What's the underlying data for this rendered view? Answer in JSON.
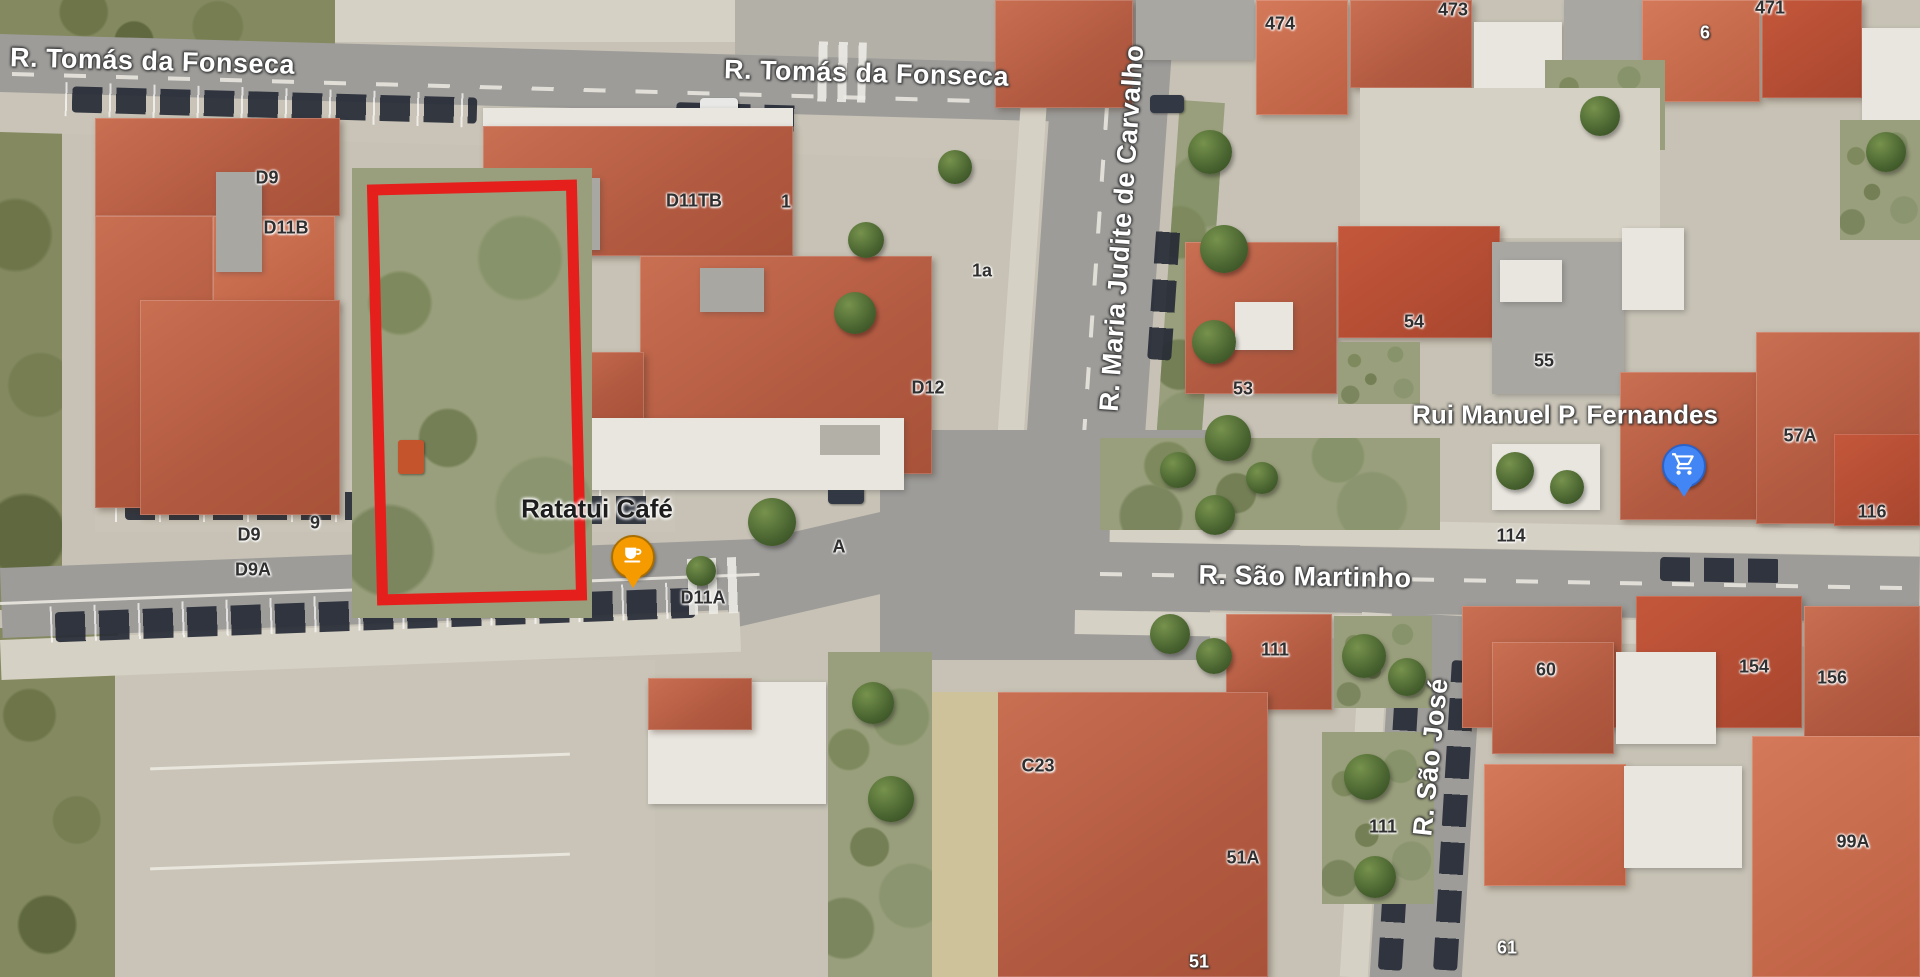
{
  "map_type": "satellite",
  "street_labels": [
    {
      "id": "r-tomas-da-fonseca-west",
      "text": "R. Tomás da Fonseca",
      "x": 10,
      "y": 46,
      "rotate": 1.5,
      "size": 27,
      "anchor": "topleft"
    },
    {
      "id": "r-tomas-da-fonseca-center",
      "text": "R. Tomás da Fonseca",
      "x": 724,
      "y": 58,
      "rotate": 1.5,
      "size": 27,
      "anchor": "topleft"
    },
    {
      "id": "r-maria-judite-de-carvalho",
      "text": "R. Maria Judite de Carvalho",
      "x": 1122,
      "y": 228,
      "rotate": -86,
      "size": 27,
      "anchor": "center"
    },
    {
      "id": "r-sao-martinho",
      "text": "R. São Martinho",
      "x": 1305,
      "y": 577,
      "rotate": 1,
      "size": 27,
      "anchor": "center"
    },
    {
      "id": "r-sao-jose",
      "text": "R. São José",
      "x": 1431,
      "y": 757,
      "rotate": -84,
      "size": 27,
      "anchor": "center"
    }
  ],
  "building_labels": [
    {
      "text": "D9",
      "x": 267,
      "y": 178
    },
    {
      "text": "D11B",
      "x": 286,
      "y": 228
    },
    {
      "text": "D11TB",
      "x": 694,
      "y": 201
    },
    {
      "text": "1",
      "x": 786,
      "y": 202
    },
    {
      "text": "1a",
      "x": 982,
      "y": 271
    },
    {
      "text": "D12",
      "x": 928,
      "y": 388
    },
    {
      "text": "9",
      "x": 315,
      "y": 523
    },
    {
      "text": "D9",
      "x": 249,
      "y": 535
    },
    {
      "text": "D9A",
      "x": 253,
      "y": 570
    },
    {
      "text": "A",
      "x": 839,
      "y": 547
    },
    {
      "text": "D11A",
      "x": 703,
      "y": 598
    },
    {
      "text": "C23",
      "x": 1038,
      "y": 766
    },
    {
      "text": "53",
      "x": 1243,
      "y": 389
    },
    {
      "text": "54",
      "x": 1414,
      "y": 322
    },
    {
      "text": "55",
      "x": 1544,
      "y": 361
    },
    {
      "text": "57A",
      "x": 1800,
      "y": 436
    },
    {
      "text": "116",
      "x": 1872,
      "y": 512
    },
    {
      "text": "114",
      "x": 1511,
      "y": 536
    },
    {
      "text": "111",
      "x": 1275,
      "y": 650
    },
    {
      "text": "60",
      "x": 1546,
      "y": 670
    },
    {
      "text": "154",
      "x": 1754,
      "y": 667
    },
    {
      "text": "156",
      "x": 1832,
      "y": 678
    },
    {
      "text": "51A",
      "x": 1243,
      "y": 858
    },
    {
      "text": "111",
      "x": 1383,
      "y": 827
    },
    {
      "text": "99A",
      "x": 1853,
      "y": 842
    },
    {
      "text": "51",
      "x": 1199,
      "y": 962,
      "light": true
    },
    {
      "text": "61",
      "x": 1507,
      "y": 948,
      "light": true
    },
    {
      "text": "474",
      "x": 1280,
      "y": 24
    },
    {
      "text": "473",
      "x": 1453,
      "y": 10
    },
    {
      "text": "471",
      "x": 1770,
      "y": 8
    },
    {
      "text": "6",
      "x": 1705,
      "y": 33,
      "light": true
    }
  ],
  "pois": [
    {
      "id": "ratatui-cafe",
      "label": "Ratatui Café",
      "label_x": 597,
      "label_y": 509,
      "marker_x": 633,
      "marker_y": 588,
      "marker_color": "#F59B00",
      "marker_border": "#A96E00",
      "icon": "coffee-cup",
      "label_style": "dark",
      "label_size": 26
    },
    {
      "id": "rui-manuel-p-fernandes",
      "label": "Rui Manuel P. Fernandes",
      "label_x": 1565,
      "label_y": 415,
      "marker_x": 1684,
      "marker_y": 497,
      "marker_color": "#4285F4",
      "marker_border": "#2A62C9",
      "icon": "shopping-cart",
      "label_style": "light",
      "label_size": 26
    }
  ],
  "annotation": {
    "type": "rectangle",
    "color": "#E5201C",
    "x": 372,
    "y": 182,
    "width": 210,
    "height": 421,
    "rotate": -1.4,
    "stroke_width": 11
  }
}
